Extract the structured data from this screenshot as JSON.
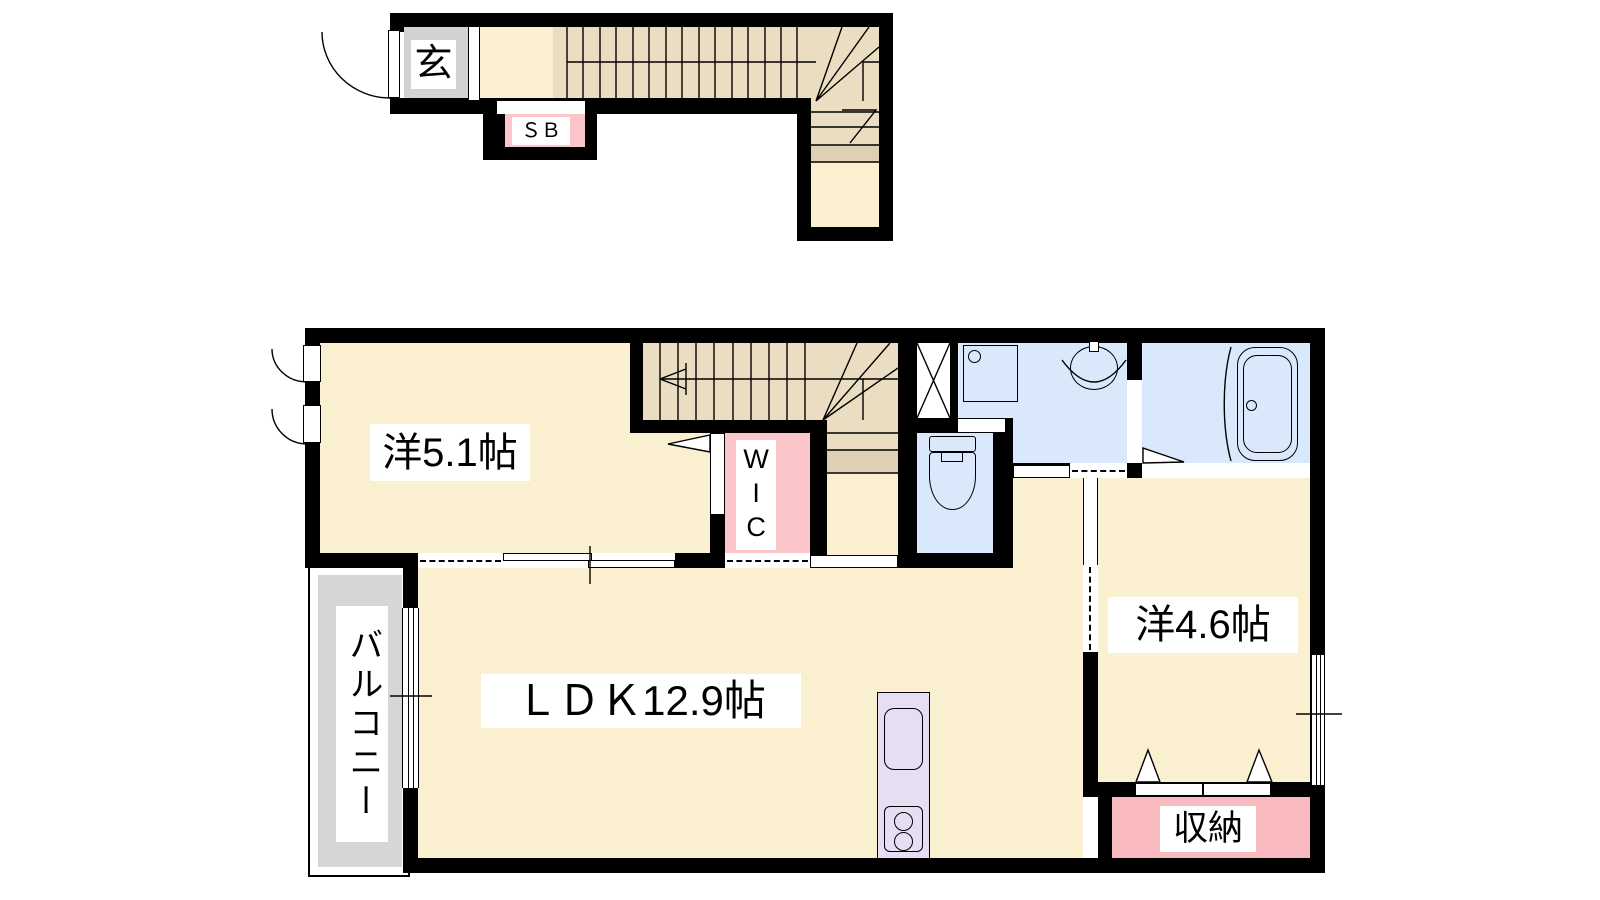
{
  "floor1": {
    "entrance_label": "玄",
    "shoe_box_label": "ＳＢ"
  },
  "floor2": {
    "bedroom1_label": "洋5.1帖",
    "wic_label": "WIC",
    "ldk_label": "ＬＤＫ12.9帖",
    "bedroom2_label": "洋4.6帖",
    "storage_label": "収納",
    "balcony_label": "バルコニー"
  },
  "fixtures": [
    "staircase",
    "pipe-space",
    "washing-machine-pan",
    "washbasin",
    "bathtub",
    "toilet",
    "kitchen-sink",
    "stove",
    "entry-door",
    "casement-window",
    "sliding-door",
    "folding-door"
  ],
  "colors": {
    "floor_cream": "#faf0cf",
    "stair_tan": "#eaddc2",
    "stair_dark": "#dfd0b5",
    "entry_gray": "#d2d2d2",
    "balcony_gray": "#d6d6d6",
    "closet_pink": "#fbc6c9",
    "storage_pink": "#fabbc0",
    "wet_blue": "#d9e8fb",
    "kitchen_lavender": "#e6def3",
    "wall_black": "#000000"
  }
}
